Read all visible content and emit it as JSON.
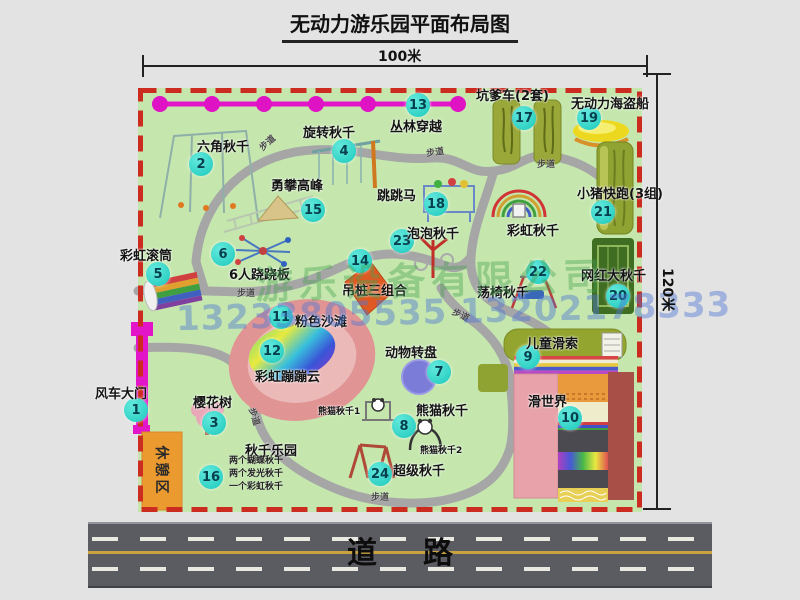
{
  "title": "无动力游乐园平面布局图",
  "dimensions": {
    "top": "100米",
    "right": "120米"
  },
  "road_label": "道路",
  "path_label": "步道",
  "rest_area_label": "休憩区",
  "rainbow_swing_label": "彩虹秋千",
  "watermark": {
    "company": "游乐设备有限公司",
    "phone": "13233805535 13202178333"
  },
  "colors": {
    "park_green": "#c5e7ae",
    "border_red": "#cc2c1f",
    "badge_cyan": "#1cc9bd",
    "path_gray": "#a6a6a6",
    "zipline_magenta": "#e215c8",
    "road_gray": "#5b5b62",
    "rest_orange": "#ea9a2f",
    "beach_pink": "#e19494"
  },
  "items": [
    {
      "num": "1",
      "label": "风车大门"
    },
    {
      "num": "2",
      "label": "六角秋千"
    },
    {
      "num": "3",
      "label": "樱花树"
    },
    {
      "num": "4",
      "label": "旋转秋千"
    },
    {
      "num": "5",
      "label": "彩虹滚筒"
    },
    {
      "num": "6",
      "label": "6人跷跷板"
    },
    {
      "num": "7",
      "label": "动物转盘"
    },
    {
      "num": "8",
      "label": "熊猫秋千",
      "sub1": "熊猫秋千1",
      "sub2": "熊猫秋千2"
    },
    {
      "num": "9",
      "label": "儿童滑索"
    },
    {
      "num": "10",
      "label": "滑世界"
    },
    {
      "num": "11",
      "label": "粉色沙滩"
    },
    {
      "num": "12",
      "label": "彩虹蹦蹦云"
    },
    {
      "num": "13",
      "label": "丛林穿越"
    },
    {
      "num": "14",
      "label": "吊桩三组合"
    },
    {
      "num": "15",
      "label": "勇攀高峰"
    },
    {
      "num": "16",
      "label": "秋千乐园",
      "notes": [
        "两个蝴蝶秋千",
        "两个发光秋千",
        "一个彩虹秋千"
      ]
    },
    {
      "num": "17",
      "label": "坑爹车(2套)"
    },
    {
      "num": "18",
      "label": "跳跳马"
    },
    {
      "num": "19",
      "label": "无动力海盗船"
    },
    {
      "num": "20",
      "label": "网红大秋千"
    },
    {
      "num": "21",
      "label": "小猪快跑(3组)"
    },
    {
      "num": "22",
      "label": "荡椅秋千"
    },
    {
      "num": "23",
      "label": "泡泡秋千"
    },
    {
      "num": "24",
      "label": "超级秋千"
    }
  ]
}
